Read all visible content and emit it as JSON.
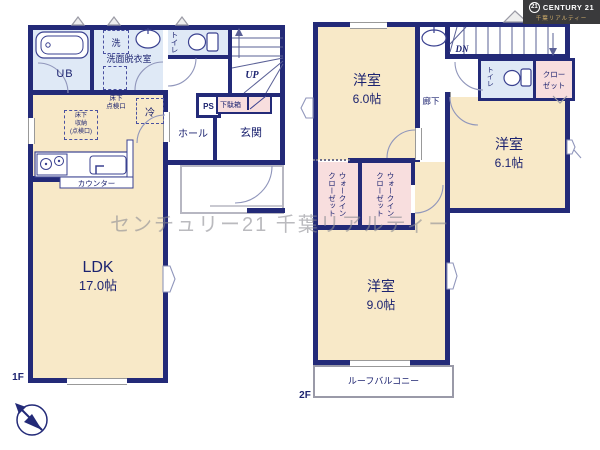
{
  "branding": {
    "logo_badge": "21",
    "logo_name": "CENTURY 21",
    "logo_sub": "千葉リアルティー",
    "watermark": "センチュリー21 千葉リアルティー"
  },
  "colors": {
    "wall": "#232a78",
    "room_cream": "#f8e9c8",
    "room_blue": "#dfe9f6",
    "room_pink": "#f8dede",
    "text_navy": "#1c2370"
  },
  "floor1": {
    "label": "1F",
    "ub": "UB",
    "laundry": "洗",
    "washroom": "洗面脱衣室",
    "toilet": "トイレ",
    "stairs_up": "UP",
    "ps": "PS",
    "shoebox": "下駄箱",
    "hall": "ホール",
    "entrance": "玄関",
    "fridge": "冷",
    "hatch_line1": "床下",
    "hatch_line2": "点検口",
    "storage_line1": "床下",
    "storage_line2": "収納",
    "storage_line3": "(点検口)",
    "ldk_name": "LDK",
    "ldk_size": "17.0帖",
    "counter": "カウンター"
  },
  "floor2": {
    "label": "2F",
    "room_a_name": "洋室",
    "room_a_size": "6.0帖",
    "room_b_name": "洋室",
    "room_b_size": "6.1帖",
    "room_c_name": "洋室",
    "room_c_size": "9.0帖",
    "toilet": "トイレ",
    "stairs_dn": "DN",
    "closet_line1": "クロー",
    "closet_line2": "ゼット",
    "wic_line1": "ウォークイン",
    "wic_line2": "クローゼット",
    "hallway": "廊下",
    "balcony": "ルーフバルコニー"
  }
}
